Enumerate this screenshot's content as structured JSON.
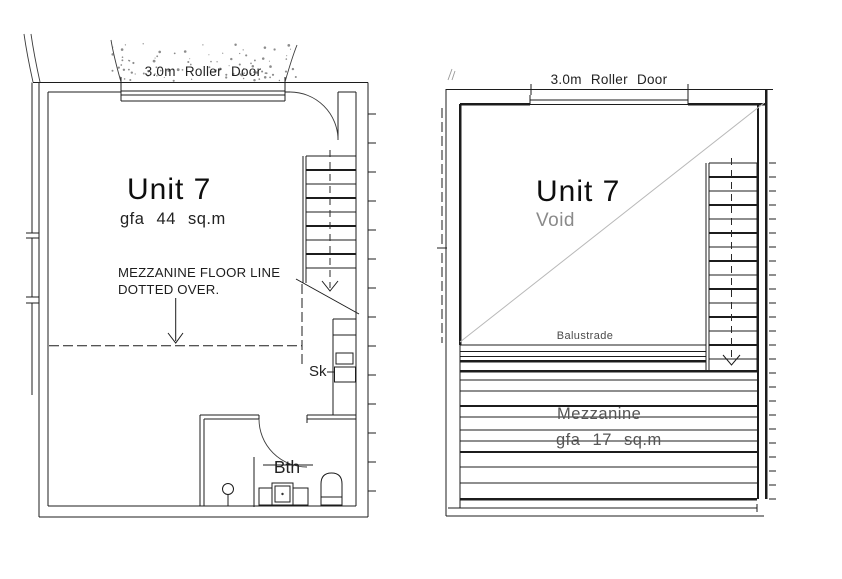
{
  "ground_floor": {
    "roller_door_label": "3.0m Roller Door",
    "unit_title": "Unit 7",
    "gfa_label": "gfa 44 sq.m",
    "mezzanine_note_line1": "MEZZANINE FLOOR LINE",
    "mezzanine_note_line2": "DOTTED OVER.",
    "sink_label": "Sk",
    "bath_label": "Bth"
  },
  "mezzanine_level": {
    "roller_door_label": "3.0m Roller Door",
    "unit_title": "Unit 7",
    "void_label": "Void",
    "balustrade_label": "Balustrade",
    "mezzanine_label": "Mezzanine",
    "gfa_label": "gfa 17 sq.m"
  },
  "colors": {
    "background": "#ffffff",
    "line": "#1c1c1c",
    "faint_line": "#b8b8b8",
    "gray_text": "#8a8a8a",
    "speckle": "#666666"
  }
}
